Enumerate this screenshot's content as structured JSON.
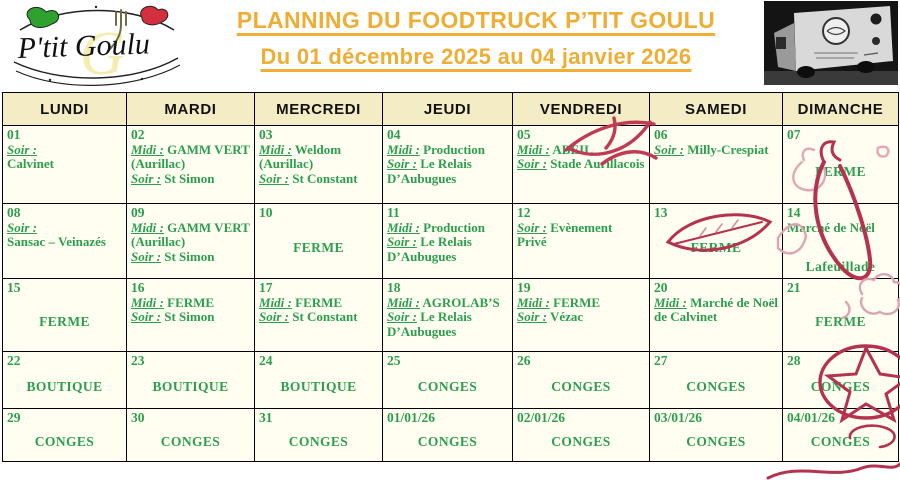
{
  "header": {
    "logo_text": "P'tit Goulu",
    "title": "PLANNING DU FOODTRUCK P’TIT GOULU",
    "subtitle": "Du 01 décembre 2025 au 04 janvier 2026"
  },
  "colors": {
    "accent_yellow": "#F0AD33",
    "text_green": "#2D9E50",
    "header_bg": "#F3ECC5",
    "cell_bg": "#FFFEF0",
    "doodle_red": "#B5324E",
    "border": "#000000"
  },
  "calendar": {
    "day_headers": [
      "LUNDI",
      "MARDI",
      "MERCREDI",
      "JEUDI",
      "VENDREDI",
      "SAMEDI",
      "DIMANCHE"
    ],
    "weeks": [
      [
        {
          "date": "01",
          "entries": [
            {
              "label": "Soir :",
              "text": ""
            },
            {
              "text": "Calvinet"
            }
          ]
        },
        {
          "date": "02",
          "entries": [
            {
              "label": "Midi :",
              "text": "GAMM VERT (Aurillac)"
            },
            {
              "label": "Soir :",
              "text": "St Simon"
            }
          ]
        },
        {
          "date": "03",
          "entries": [
            {
              "label": "Midi :",
              "text": "Weldom (Aurillac)"
            },
            {
              "label": "Soir :",
              "text": "St Constant"
            }
          ]
        },
        {
          "date": "04",
          "entries": [
            {
              "label": "Midi :",
              "text": "Production"
            },
            {
              "label": "Soir :",
              "text": "Le Relais D’Aubugues"
            }
          ]
        },
        {
          "date": "05",
          "entries": [
            {
              "label": "Midi :",
              "text": "ABEIL"
            },
            {
              "label": "Soir :",
              "text": "Stade Aurillacois"
            }
          ]
        },
        {
          "date": "06",
          "entries": [
            {
              "label": "Soir :",
              "text": "Milly-Crespiat"
            }
          ]
        },
        {
          "date": "07",
          "note": "FERME"
        }
      ],
      [
        {
          "date": "08",
          "entries": [
            {
              "label": "Soir :",
              "text": ""
            },
            {
              "text": "Sansac – Veinazés"
            }
          ]
        },
        {
          "date": "09",
          "entries": [
            {
              "label": "Midi :",
              "text": "GAMM VERT (Aurillac)"
            },
            {
              "label": "Soir :",
              "text": "St Simon"
            }
          ]
        },
        {
          "date": "10",
          "note": "FERME"
        },
        {
          "date": "11",
          "entries": [
            {
              "label": "Midi :",
              "text": "Production"
            },
            {
              "label": "Soir :",
              "text": "Le Relais D’Aubugues"
            }
          ]
        },
        {
          "date": "12",
          "entries": [
            {
              "label": "Soir :",
              "text": "Evènement Privé"
            }
          ]
        },
        {
          "date": "13",
          "note": "FERME"
        },
        {
          "date": "14",
          "entries": [
            {
              "text": "Marché de Noël"
            }
          ],
          "note": "Lafeuillade"
        }
      ],
      [
        {
          "date": "15",
          "note": "FERME"
        },
        {
          "date": "16",
          "entries": [
            {
              "label": "Midi :",
              "text": "FERME"
            },
            {
              "label": "Soir :",
              "text": "St Simon"
            }
          ]
        },
        {
          "date": "17",
          "entries": [
            {
              "label": "Midi :",
              "text": "FERME"
            },
            {
              "label": "Soir :",
              "text": "St Constant"
            }
          ]
        },
        {
          "date": "18",
          "entries": [
            {
              "label": "Midi :",
              "text": "AGROLAB’S"
            },
            {
              "label": "Soir :",
              "text": "Le Relais D’Aubugues"
            }
          ]
        },
        {
          "date": "19",
          "entries": [
            {
              "label": "Midi :",
              "text": "FERME"
            },
            {
              "label": "Soir :",
              "text": "Vézac"
            }
          ]
        },
        {
          "date": "20",
          "entries": [
            {
              "label": "Midi :",
              "text": "Marché de Noël de Calvinet"
            }
          ]
        },
        {
          "date": "21",
          "note": "FERME"
        }
      ],
      [
        {
          "date": "22",
          "note": "BOUTIQUE"
        },
        {
          "date": "23",
          "note": "BOUTIQUE"
        },
        {
          "date": "24",
          "note": "BOUTIQUE"
        },
        {
          "date": "25",
          "note": "CONGES"
        },
        {
          "date": "26",
          "note": "CONGES"
        },
        {
          "date": "27",
          "note": "CONGES"
        },
        {
          "date": "28",
          "note": "CONGES"
        }
      ],
      [
        {
          "date": "29",
          "note": "CONGES"
        },
        {
          "date": "30",
          "note": "CONGES"
        },
        {
          "date": "31",
          "note": "CONGES"
        },
        {
          "date": "01/01/26",
          "note": "CONGES"
        },
        {
          "date": "02/01/26",
          "note": "CONGES"
        },
        {
          "date": "03/01/26",
          "note": "CONGES"
        },
        {
          "date": "04/01/26",
          "note": "CONGES"
        }
      ]
    ]
  }
}
